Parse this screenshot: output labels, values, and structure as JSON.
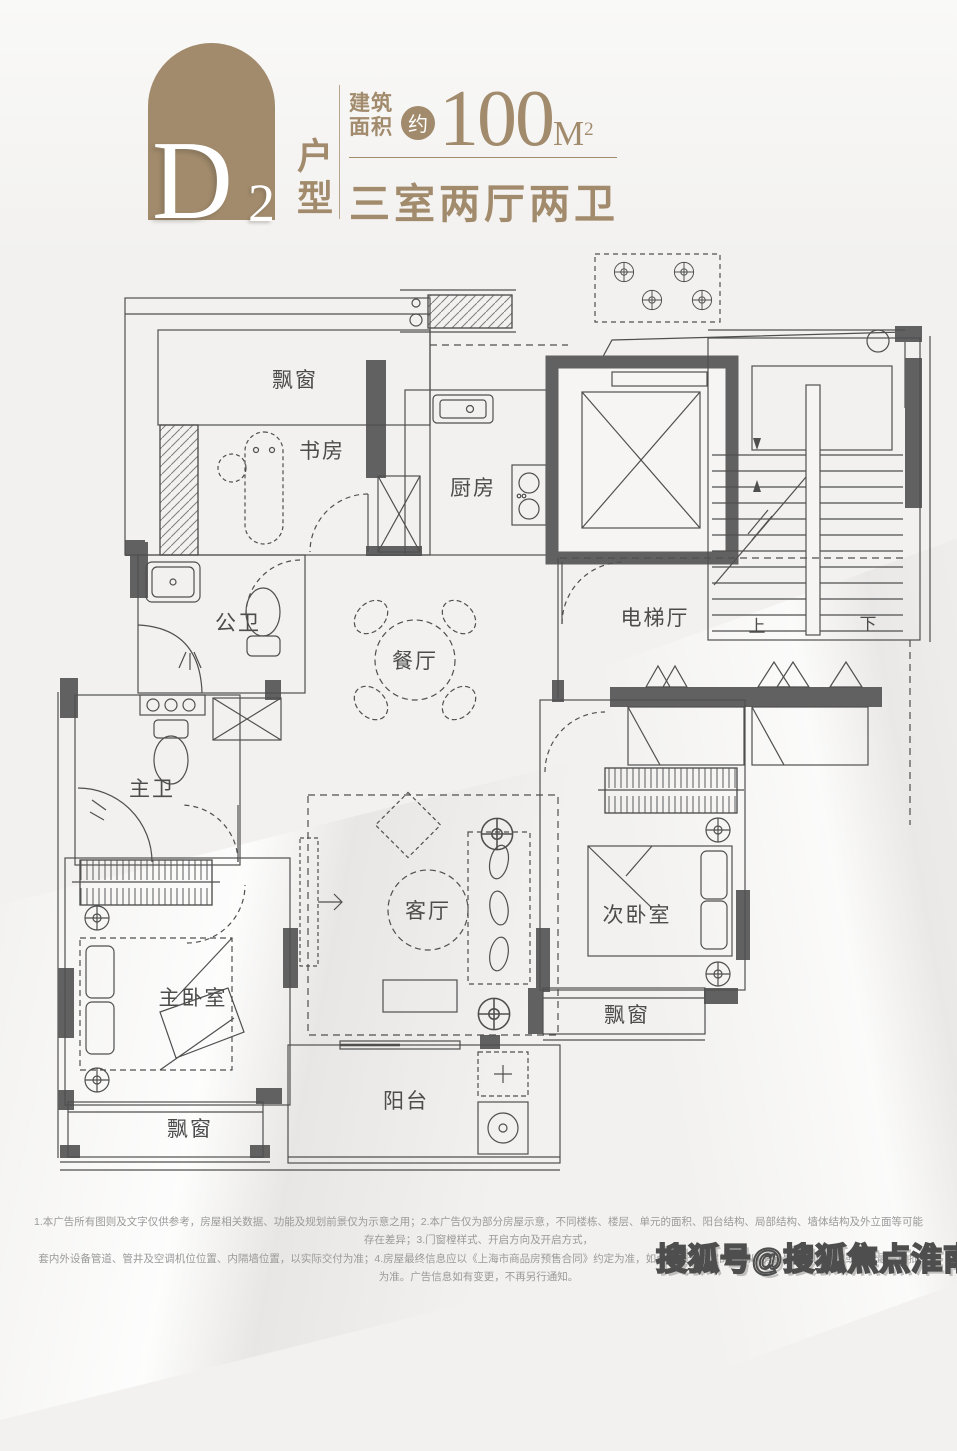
{
  "colors": {
    "accent": "#a28b6c",
    "plan_line": "#4f4f4f",
    "plan_wall": "#616161",
    "background": "#f2f1ef"
  },
  "header": {
    "plan_letter": "D",
    "plan_digit": "2",
    "plan_suffix": "户型",
    "area_label_1": "建筑",
    "area_label_2": "面积",
    "approx": "约",
    "area_value": "100",
    "area_unit": "M",
    "area_unit_exp": "2",
    "layout_summary": "三室两厅两卫"
  },
  "floor_plan": {
    "labels": {
      "bay_window_top": "飘窗",
      "study": "书房",
      "kitchen": "厨房",
      "public_bath": "公卫",
      "dining": "餐厅",
      "elevator_hall": "电梯厅",
      "stairs_up": "上",
      "stairs_down": "下",
      "master_bath": "主卫",
      "living": "客厅",
      "second_bedroom": "次卧室",
      "master_bedroom": "主卧室",
      "bay_window_right": "飘窗",
      "bay_window_bottom": "飘窗",
      "balcony": "阳台"
    }
  },
  "footer": {
    "line1": "1.本广告所有图则及文字仅供参考，房屋相关数据、功能及规划前景仅为示意之用；2.本广告仅为部分房屋示意，不同楼栋、楼层、单元的面积、阳台结构、局部结构、墙体结构及外立面等可能存在差异；3.门窗樘样式、开启方向及开启方式，",
    "line2": "套内外设备管道、管井及空调机位位置、内隔墙位置，以实际交付为准；4.房屋最终信息应以《上海市商品房预售合同》约定为准，如合同未予约定的，则以房屋最终实际状况或政府最后审批为准。广告信息如有变更，不再另行通知。"
  },
  "watermark": {
    "text": "搜狐号@搜狐焦点淮南站"
  }
}
